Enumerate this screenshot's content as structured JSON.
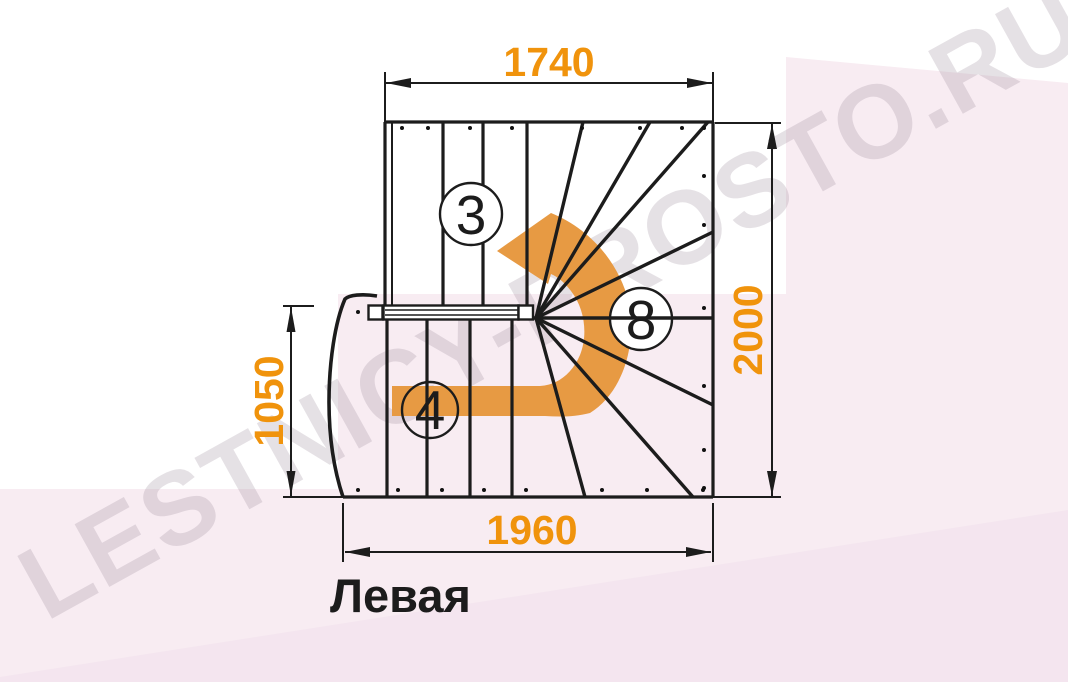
{
  "title": {
    "text": "Левая"
  },
  "watermark": {
    "text": "LESTNICY-PROSTO.RU"
  },
  "dimensions": {
    "top": "1740",
    "right": "2000",
    "left": "1050",
    "bottom": "1960"
  },
  "step_counts": {
    "upper_flight": "3",
    "winder": "8",
    "lower_flight": "4"
  },
  "colors": {
    "accent_orange": "#F0930C",
    "arrow_orange": "#E79A43",
    "line": "#1C1C1C",
    "background_pink": "#F8ECF2"
  }
}
